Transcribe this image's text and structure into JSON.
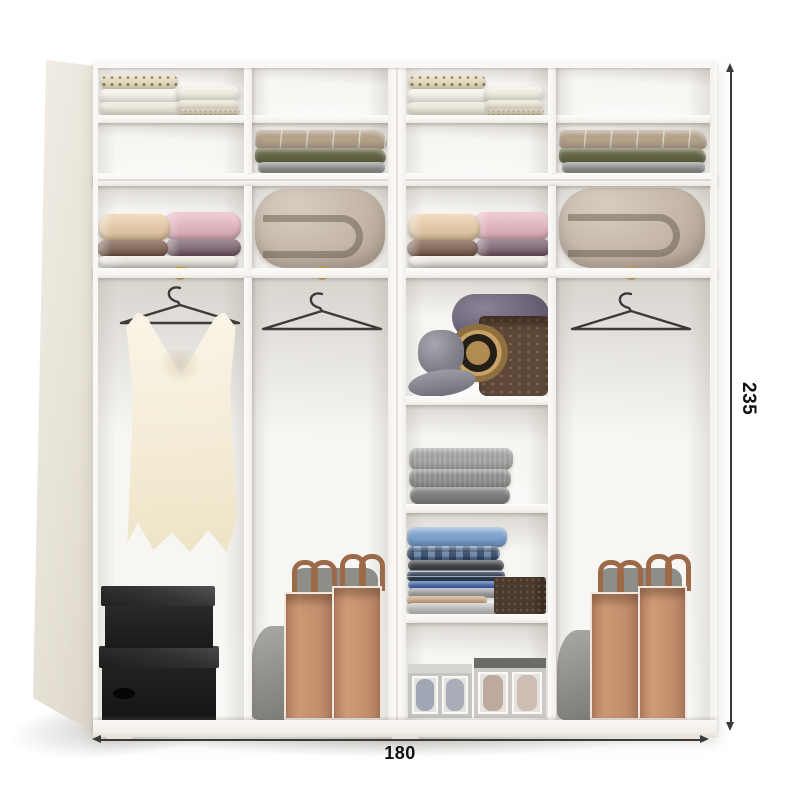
{
  "annotations": {
    "height_label": "235",
    "width_label": "180"
  },
  "wardrobe": {
    "style": "white two-module open wardrobe with mezzanine top cabinet, dimension drawing",
    "modules": [
      {
        "name": "left-module",
        "mezzanine_row1": [
          "folded white linens, dotted roll, two cream pillows",
          "empty"
        ],
        "mezzanine_row2": [
          "empty",
          "folded blankets: taupe striped, olive, grey"
        ],
        "middle_shelf": [
          "folded towels: peach, pink, brown, plum, white",
          "rolled greige duvet"
        ],
        "lower_left_column": [
          "brass rod hook",
          "black wire hanger with ivory sleeveless top",
          "two black storage boxes"
        ],
        "lower_right_column": [
          "brass rod hook",
          "empty black wire hanger",
          "grey pouch",
          "two tan storage bags with brown straps"
        ]
      },
      {
        "name": "right-module",
        "mezzanine_row1": [
          "folded white linens, dotted roll, two cream pillows",
          "empty"
        ],
        "mezzanine_row2": [
          "empty",
          "folded blankets: taupe striped, olive, grey"
        ],
        "middle_shelf": [
          "folded towels: peach, pink, brown, plum, white",
          "rolled greige duvet"
        ],
        "lower_left_column": [
          "grey fedora, straw hat and wicker basket with plum fabric",
          "folded grey knitwear",
          "stack of blue shirts with brown textured box",
          "two underwear organizer boxes"
        ],
        "lower_right_column": [
          "brass rod hook",
          "empty black wire hanger",
          "grey pouch",
          "two tan storage bags with brown straps"
        ]
      }
    ],
    "colors": {
      "cabinet_white": "#f8f6f3",
      "side_panel_cream": "#e9e3d9",
      "dimension_line": "#3a3a3a",
      "label_text": "#111111",
      "hanger_wire": "#3c3b38",
      "hook_brass": "#bf9a43",
      "garment_ivory": "#f5eed9",
      "box_black": "#222222",
      "bag_tan": "#c48e6d",
      "pouch_grey": "#97968f",
      "duvet_greige": "#c3b5a8",
      "towel_peach": "#eecfa6",
      "towel_pink": "#eeb9c5",
      "towel_brown": "#7a5947",
      "towel_plum": "#7c5f6d",
      "blanket_taupe": "#b3a189",
      "blanket_olive": "#666747",
      "blanket_grey": "#909290",
      "shirt_blue": "#7da2cd",
      "basket_brown": "#5c4739"
    }
  }
}
